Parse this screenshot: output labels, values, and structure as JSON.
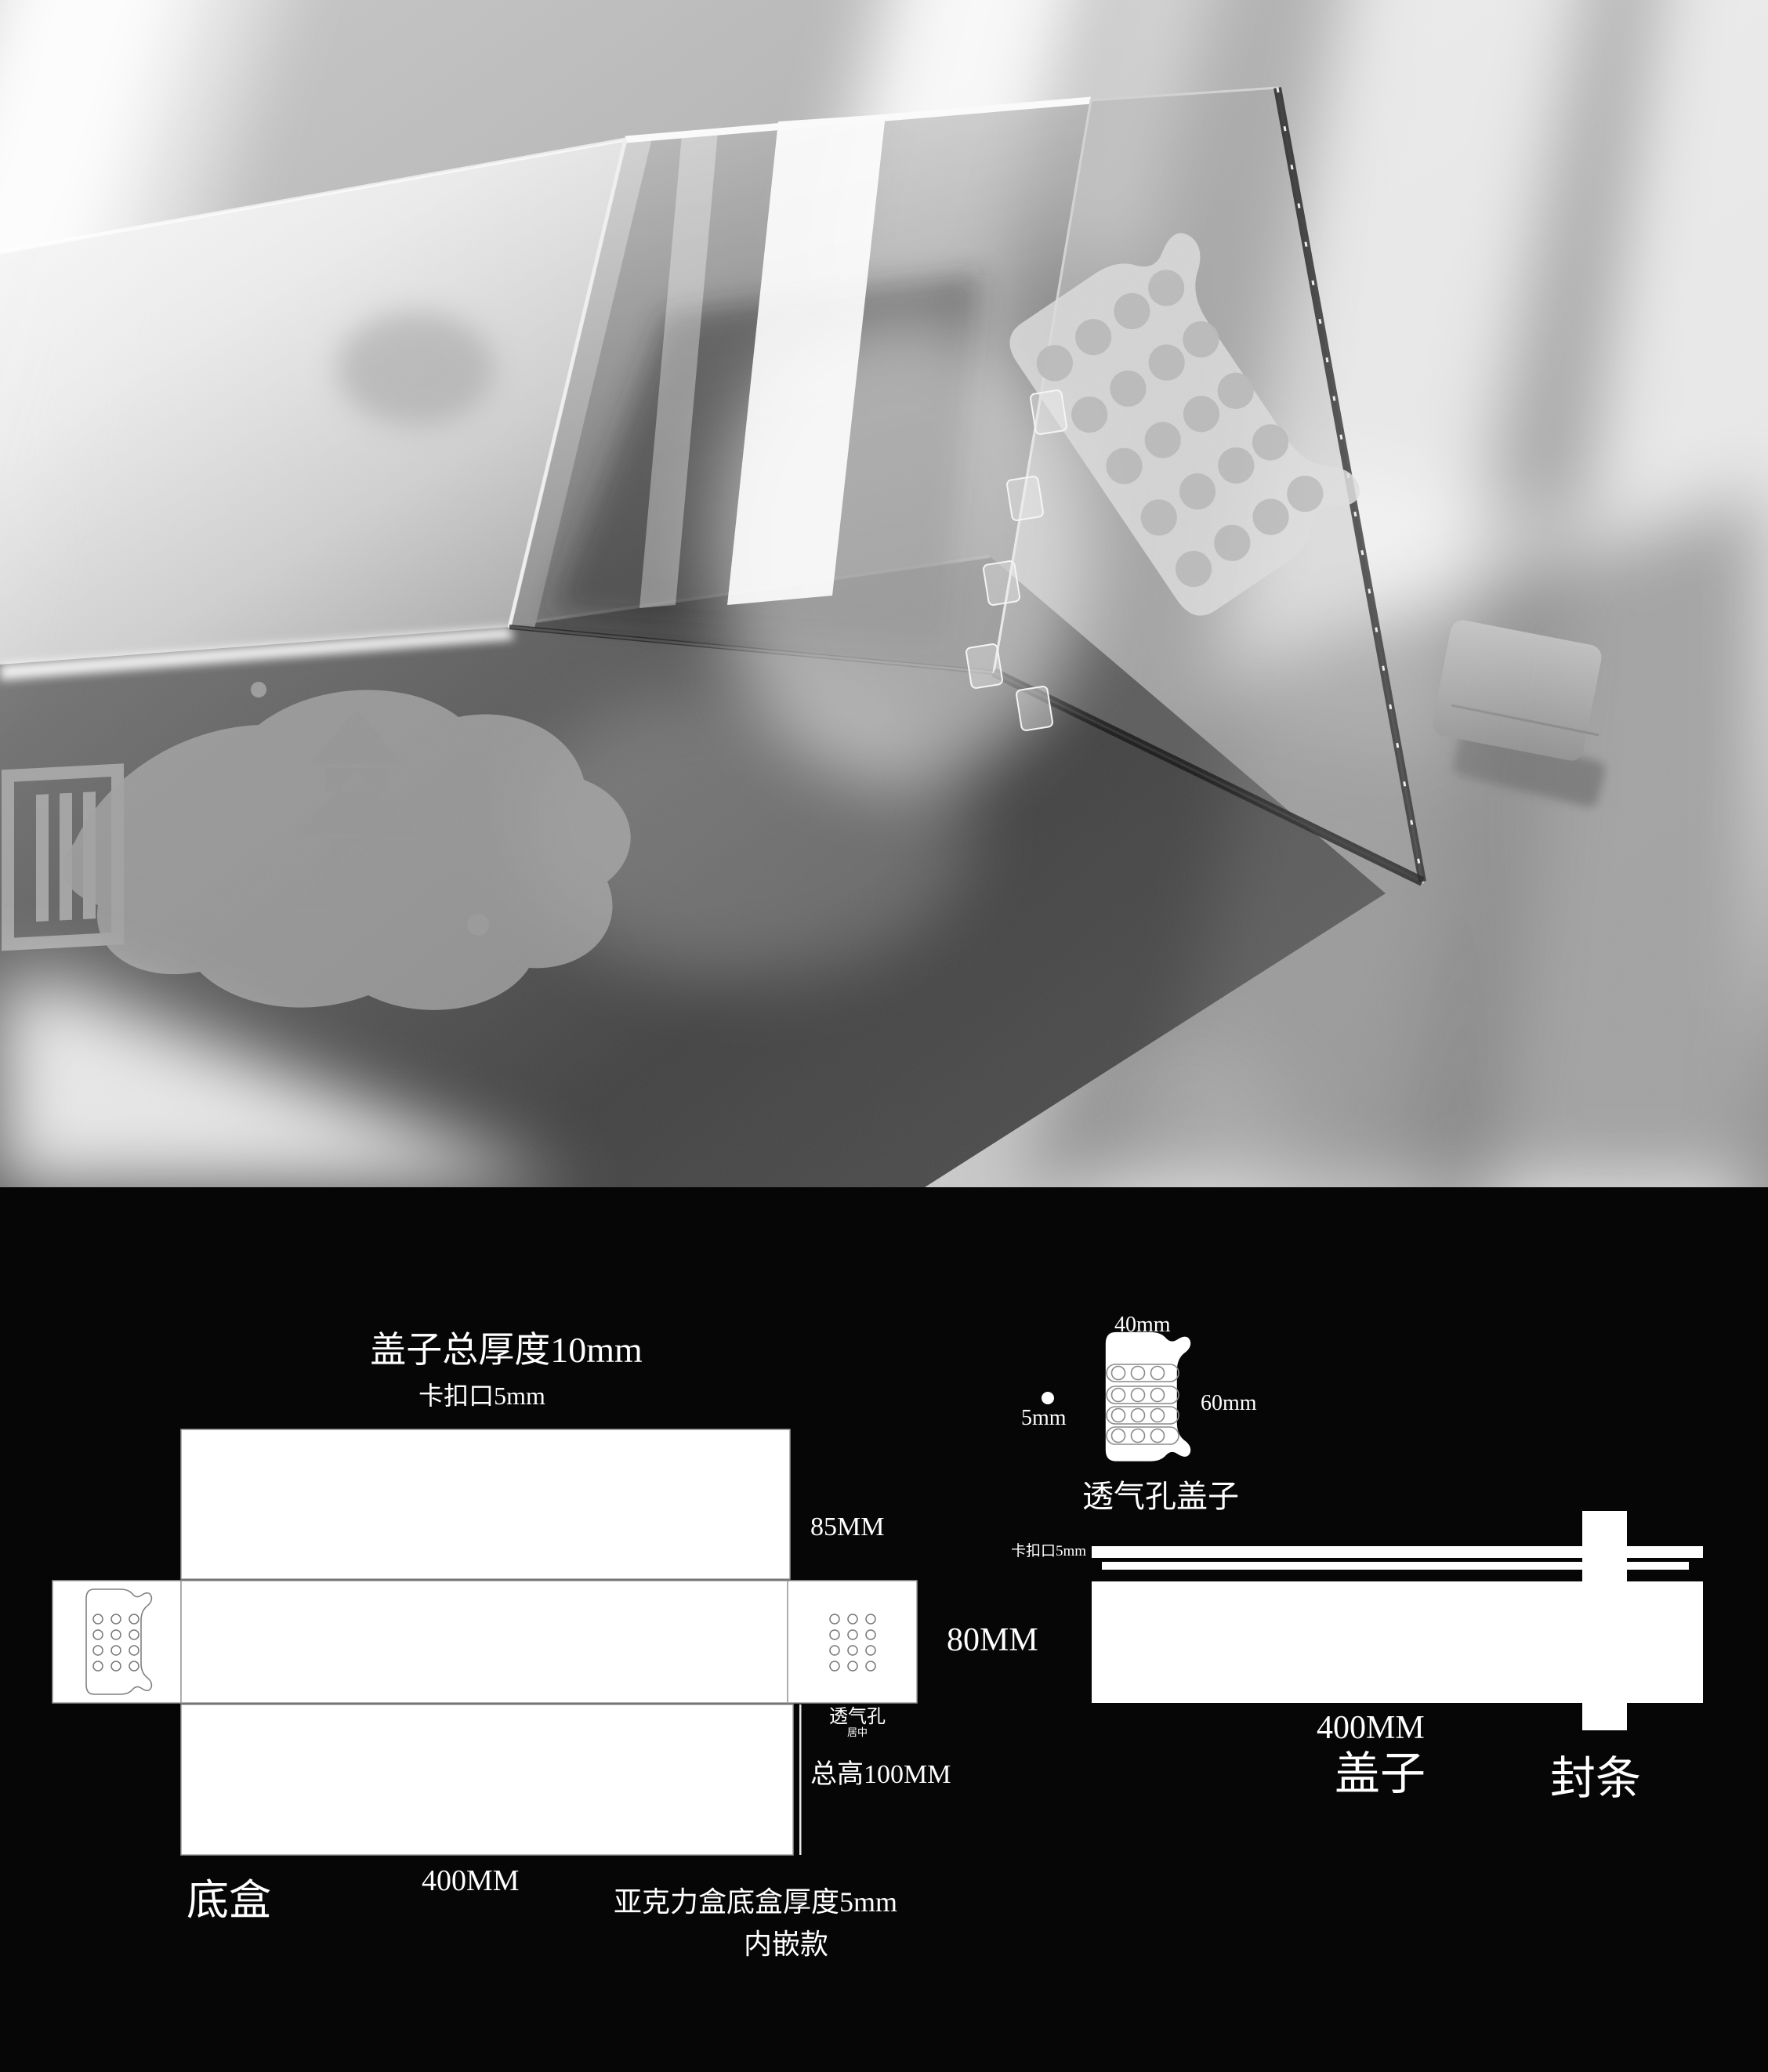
{
  "colors": {
    "page_bg": "#060606",
    "diagram_fill": "#ffffff",
    "diagram_line": "#8f8f8f",
    "text": "#ffffff"
  },
  "bottom_box_diagram": {
    "lid_thickness_note": "盖子总厚度10mm",
    "snap_note": "卡扣口5mm",
    "flap_height": "85MM",
    "band_height": "80MM",
    "vent_label": "透气孔",
    "vent_align_label": "居中",
    "total_height": "总高100MM",
    "width_label": "400MM",
    "part_name": "底盒",
    "material_note": "亚克力盒底盒厚度5mm",
    "style_note": "内嵌款"
  },
  "vent_cover_diagram": {
    "width_label": "40mm",
    "height_label": "60mm",
    "hole_label": "5mm",
    "part_name": "透气孔盖子"
  },
  "lid_diagram": {
    "snap_note": "卡扣口5mm",
    "width_label": "400MM",
    "part_name": "盖子",
    "seal_name": "封条"
  }
}
